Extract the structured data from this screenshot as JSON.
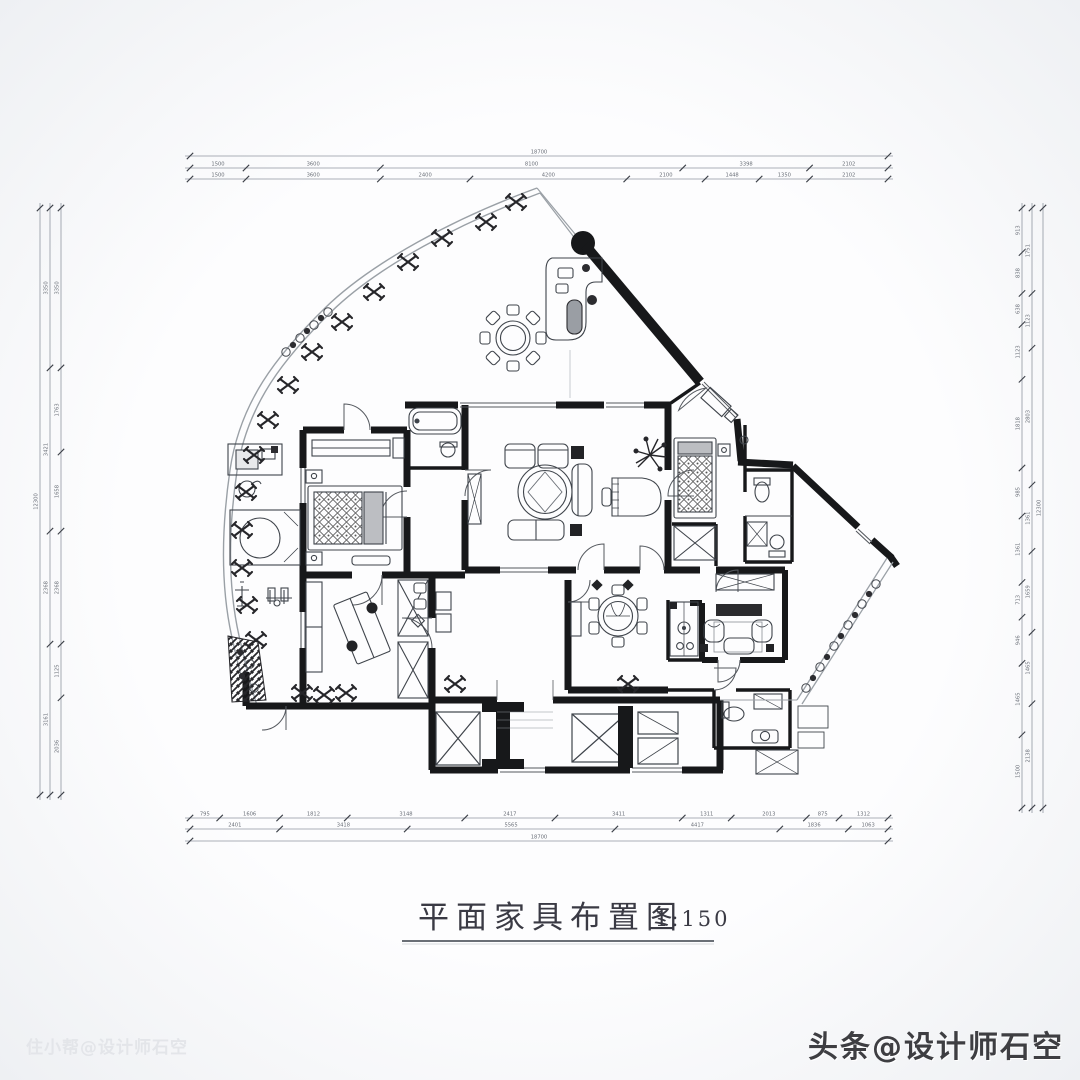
{
  "title": {
    "text": "平面家具布置图",
    "scale": "1:150"
  },
  "watermarks": {
    "bottom_right": "头条@设计师石空",
    "bottom_left": "住小帮@设计师石空"
  },
  "colors": {
    "wall": "#17181a",
    "line": "#3f444b",
    "light_line": "#9aa0a6",
    "dim_line": "#9096a0",
    "dim_text": "#6a6f78",
    "title_text": "#3a3a44"
  },
  "plan": {
    "type": "residential floor plan with furniture layout",
    "drawing_scale": "1:150"
  },
  "dimensions": {
    "top": {
      "range": [
        190,
        888
      ],
      "rows": [
        {
          "offset": 156,
          "labels": [
            "18700"
          ]
        },
        {
          "offset": 168,
          "labels": [
            "1500",
            "3600",
            "8100",
            "3398",
            "2102"
          ]
        },
        {
          "offset": 179,
          "labels": [
            "1500",
            "3600",
            "2400",
            "4200",
            "2100",
            "1448",
            "1350",
            "2102"
          ]
        }
      ]
    },
    "bottom": {
      "range": [
        190,
        888
      ],
      "rows": [
        {
          "offset": 818,
          "labels": [
            "795",
            "1606",
            "1812",
            "3148",
            "2417",
            "3411",
            "1311",
            "2013",
            "875",
            "1312"
          ]
        },
        {
          "offset": 829,
          "labels": [
            "2401",
            "3418",
            "5565",
            "4417",
            "1836",
            "1063"
          ]
        },
        {
          "offset": 841,
          "labels": [
            "18700"
          ]
        }
      ]
    },
    "left": {
      "range": [
        208,
        795
      ],
      "rows": [
        {
          "offset": 40,
          "labels": [
            "12300"
          ]
        },
        {
          "offset": 50,
          "labels": [
            "3350",
            "3421",
            "2368",
            "3161"
          ]
        },
        {
          "offset": 61,
          "labels": [
            "3350",
            "1763",
            "1658",
            "2368",
            "1125",
            "2036"
          ]
        }
      ]
    },
    "right": {
      "range": [
        208,
        808
      ],
      "rows": [
        {
          "offset": 1022,
          "labels": [
            "913",
            "838",
            "638",
            "1123",
            "1818",
            "985",
            "1361",
            "713",
            "946",
            "1465",
            "1500"
          ]
        },
        {
          "offset": 1032,
          "labels": [
            "1751",
            "1123",
            "2803",
            "1361",
            "1659",
            "1465",
            "2138"
          ]
        },
        {
          "offset": 1043,
          "labels": [
            "12300"
          ]
        }
      ]
    }
  }
}
